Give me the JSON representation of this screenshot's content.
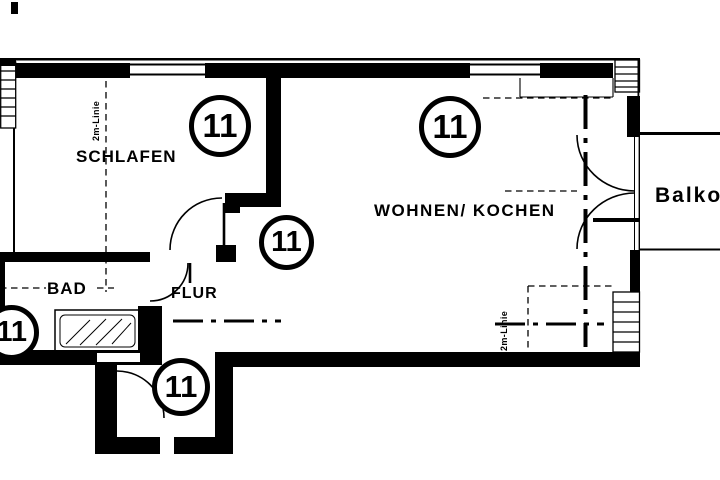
{
  "title": "Wohnung 11 Grundriss",
  "rooms": {
    "schlafen": "SCHLAFEN",
    "wohnen_kochen": "WOHNEN/ KOCHEN",
    "bad": "BAD",
    "flur": "FLUR",
    "balkon": "Balkon"
  },
  "annotations": {
    "two_meter_line_left": "2m-Linie",
    "two_meter_line_right": "2m-Linie"
  },
  "badges": [
    {
      "number": "11"
    },
    {
      "number": "11"
    },
    {
      "number": "11"
    },
    {
      "number": "11"
    },
    {
      "number": "11"
    }
  ],
  "colors": {
    "line": "#000000",
    "background": "#ffffff"
  }
}
